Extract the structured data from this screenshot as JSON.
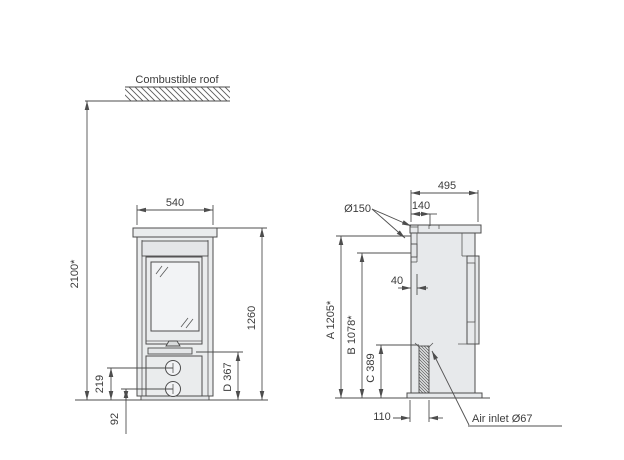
{
  "front_view": {
    "roof_label": "Combustible roof",
    "dims": {
      "width": "540",
      "height": "1260",
      "floor_to_ceiling": "2100*",
      "upper_connection_height": "219",
      "lower_connection_height": "92",
      "d": "D 367"
    }
  },
  "side_view": {
    "dims": {
      "depth": "495",
      "flue_center_from_back": "140",
      "flue_diameter": "Ø150",
      "back_offset": "40",
      "a": "A 1205*",
      "b": "B 1078*",
      "c": "C 389",
      "air_inlet_from_back": "110"
    },
    "air_inlet_label": "Air inlet Ø67"
  },
  "colors": {
    "line": "#4d4d4d",
    "text": "#3c3c3c",
    "body_fill": "#eaeced",
    "panel_fill": "#e4e6e8",
    "glass_fill": "#f2f3f5",
    "background": "#ffffff"
  }
}
